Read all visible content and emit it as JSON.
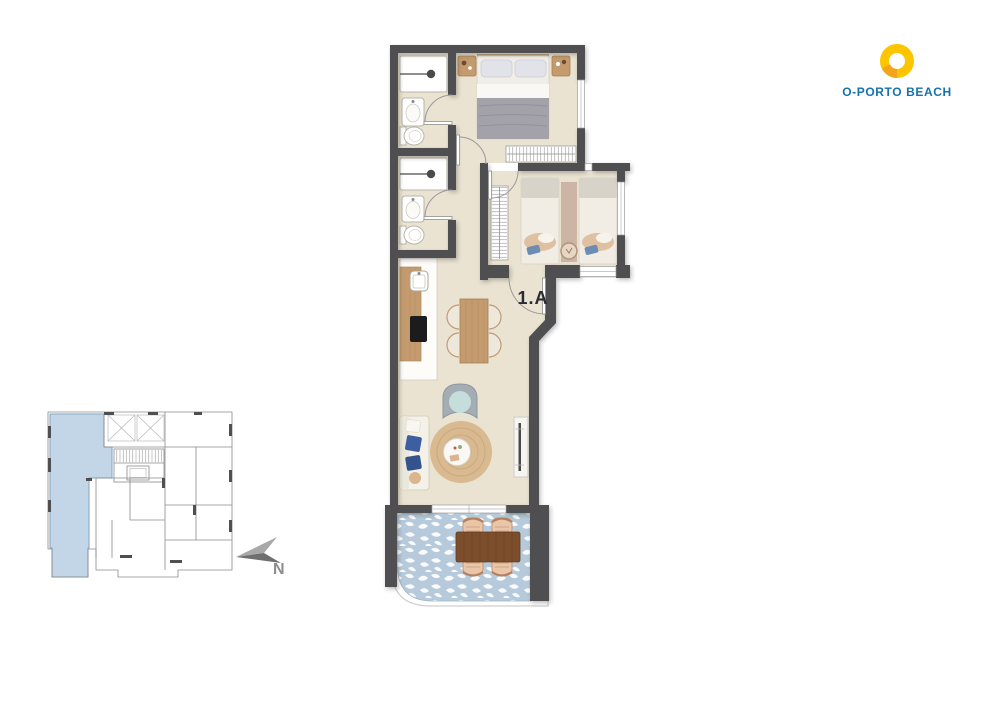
{
  "branding": {
    "logo_text": "O-PORTO BEACH",
    "logo_icon": "sun-ring-icon"
  },
  "unit": {
    "label": "1.A"
  },
  "compass": {
    "north_label": "N"
  },
  "colors": {
    "wall": "#4f4f51",
    "floor": "#eae3d2",
    "terrace-tile": "#b6cadb",
    "keyplan-highlight": "#c3d6e8",
    "keyplan-highlight-stroke": "#82a5c5",
    "brand-yellow": "#fdc400",
    "brand-orange": "#f2a51b",
    "brand-blue": "#1572ae",
    "unit-text": "#2b2b33",
    "compass-gray": "#8c8c8c",
    "wood-light": "#c49b6e",
    "wood-dark": "#7c4e2c",
    "rug": "#d9ba90"
  }
}
